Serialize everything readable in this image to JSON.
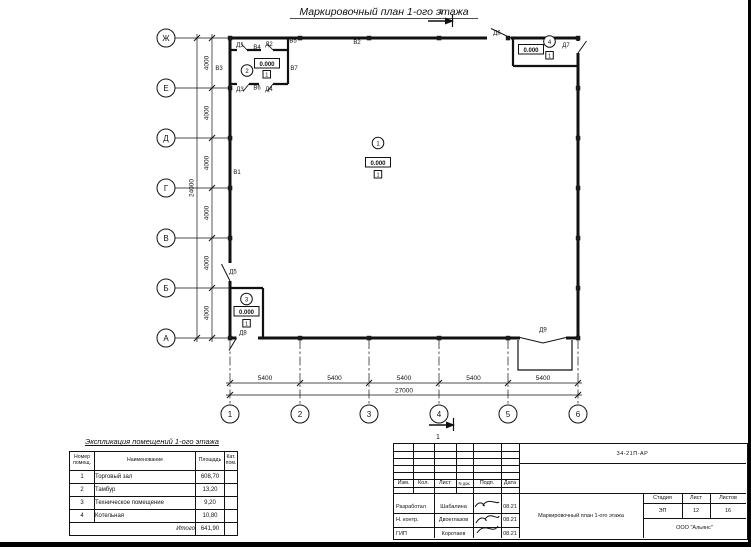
{
  "page": {
    "title": "Маркировочный план 1-ого этажа",
    "section_label": "1"
  },
  "plan": {
    "elevation": "0.000",
    "floor_type_mark": "1",
    "room_numbers": {
      "hall": "1",
      "tambour": "2",
      "tech": "3",
      "boiler": "4"
    },
    "row_axes": [
      "Ж",
      "Е",
      "Д",
      "Г",
      "В",
      "Б",
      "А"
    ],
    "col_axes": [
      "1",
      "2",
      "3",
      "4",
      "5",
      "6"
    ],
    "dims": {
      "bay_h": "5400",
      "total_h": "27000",
      "bay_v": "4000",
      "total_v": "24000"
    },
    "marks": {
      "d1": "Д1",
      "d2": "Д2",
      "d3": "Д3",
      "d4": "Д4",
      "d5": "Д5",
      "d6": "Д6",
      "d7": "Д7",
      "d8": "Д8",
      "d9": "Д9",
      "v1": "В1",
      "v2": "В2",
      "v3": "В3",
      "v4": "В4",
      "v5": "В5",
      "v6": "В6",
      "v7": "В7"
    }
  },
  "explication": {
    "title": "Экспликация помещений 1-ого этажа",
    "headers": {
      "num": "Номер помещ.",
      "name": "Наименование",
      "area": "Площадь",
      "cat": "Кат. пом."
    },
    "rows": [
      {
        "num": "1",
        "name": "Торговый зал",
        "area": "608,70"
      },
      {
        "num": "2",
        "name": "Тамбур",
        "area": "13,20"
      },
      {
        "num": "3",
        "name": "Техническое помещение",
        "area": "9,20"
      },
      {
        "num": "4",
        "name": "Котельная",
        "area": "10,80"
      }
    ],
    "total_label": "Итого",
    "total_value": "641,90"
  },
  "titleblock": {
    "doc_number": "34-21П-АР",
    "columns": {
      "izm": "Изм.",
      "kol": "Кол.",
      "list": "Лист",
      "doc": "N док.",
      "sign": "Подп.",
      "date": "Дата"
    },
    "people": [
      {
        "role": "Разработал",
        "name": "Шабалина",
        "date": "08.21"
      },
      {
        "role": "Н. контр.",
        "name": "Двоеглазов",
        "date": "08.21"
      },
      {
        "role": "ГИП",
        "name": "Коротаев",
        "date": "08.21"
      }
    ],
    "stage_cols": {
      "stage": "Стадия",
      "sheet": "Лист",
      "sheets": "Листов"
    },
    "stage": "ЭП",
    "sheet": "12",
    "sheets": "16",
    "drawing_title": "Маркировочный план 1-ого этажа",
    "company": "ООО \"Альянс\""
  }
}
